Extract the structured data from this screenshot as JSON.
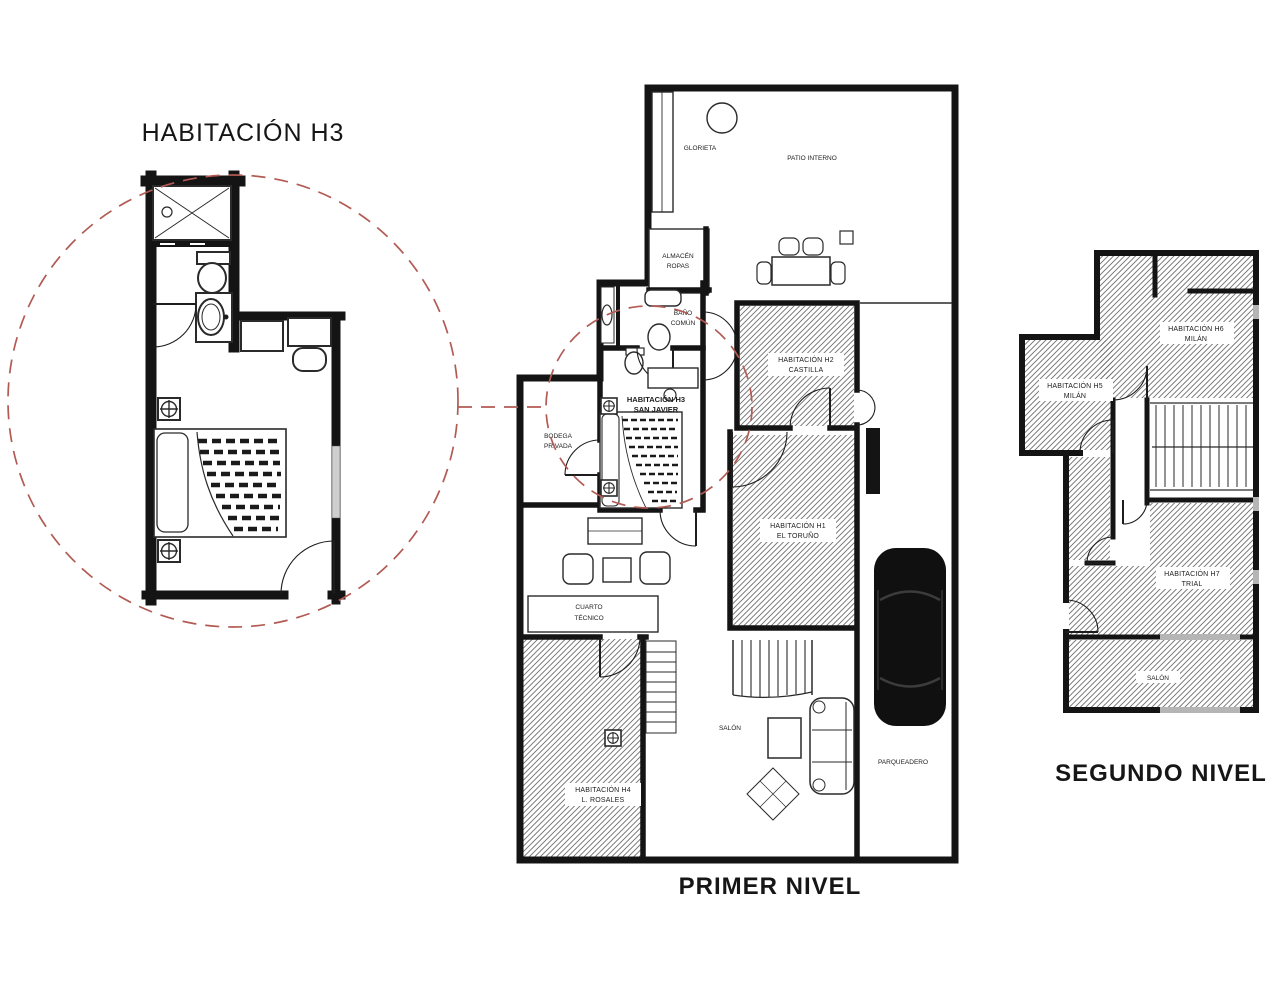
{
  "titles": {
    "detail": "HABITACIÓN H3",
    "level1": "PRIMER NIVEL",
    "level2": "SEGUNDO NIVEL"
  },
  "colors": {
    "wall": "#141414",
    "hatch_line": "#6f6f6f",
    "callout_red": "#b25b54",
    "window_gray": "#b5b5b5",
    "background": "#ffffff"
  },
  "l1": {
    "glorieta": "GLORIETA",
    "patio": "PATIO INTERNO",
    "almacen1": "ALMACÉN",
    "almacen2": "ROPAS",
    "bano1": "BAÑO",
    "bano2": "COMÚN",
    "h3a": "HABITACIÓN H3",
    "h3b": "SAN JAVIER",
    "h2a": "HABITACIÓN H2",
    "h2b": "CASTILLA",
    "h1a": "HABITACIÓN H1",
    "h1b": "EL TORUÑO",
    "h4a": "HABITACIÓN H4",
    "h4b": "L. ROSALES",
    "bodega1": "BODEGA",
    "bodega2": "PRIVADA",
    "cuarto1": "CUARTO",
    "cuarto2": "TÉCNICO",
    "salon": "SALÓN",
    "parqueadero": "PARQUEADERO"
  },
  "l2": {
    "habAa": "HABITACIÓN H6",
    "habAb": "MILÁN",
    "habBa": "HABITACIÓN H5",
    "habBb": "MILÁN",
    "habCa": "HABITACIÓN H7",
    "habCb": "TRIAL",
    "salon": "SALÓN"
  }
}
